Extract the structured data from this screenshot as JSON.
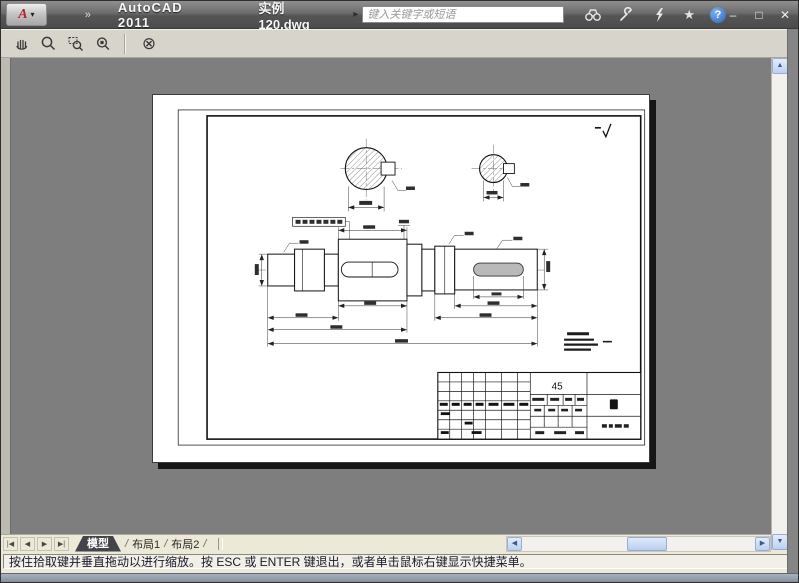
{
  "titlebar": {
    "app_title": "AutoCAD 2011",
    "document_name": "实例120.dwg",
    "overflow_glyph": "»",
    "app_menu_caret": "▾",
    "flyout_glyph": "▸",
    "search_placeholder": "键入关键字或短语",
    "star_glyph": "★",
    "help_glyph": "?",
    "window_controls": {
      "minimize": "–",
      "maximize": "□",
      "close": "✕"
    }
  },
  "toolbar": {
    "close_preview_glyph": "⊗"
  },
  "tabs": {
    "nav": [
      "|◀",
      "◀",
      "▶",
      "▶|"
    ],
    "separator": "/",
    "items": [
      {
        "label": "模型",
        "active": true
      },
      {
        "label": "布局1",
        "active": false
      },
      {
        "label": "布局2",
        "active": false
      }
    ]
  },
  "scrollbars": {
    "up": "▲",
    "down": "▼",
    "left": "◀",
    "right": "▶"
  },
  "statusbar": {
    "message": "按住拾取键并垂直拖动以进行缩放。按 ESC 或 ENTER 键退出，或者单击鼠标右键显示快捷菜单。"
  },
  "drawing": {
    "material_label": "45"
  },
  "colors": {
    "titlebar_dark": "#4c4c4c",
    "toolbar": "#d7d4cb",
    "chrome": "#ece9d8",
    "canvas": "#7e7e7e",
    "scroll_face": "#bcd1f0",
    "paper": "#ffffff"
  }
}
